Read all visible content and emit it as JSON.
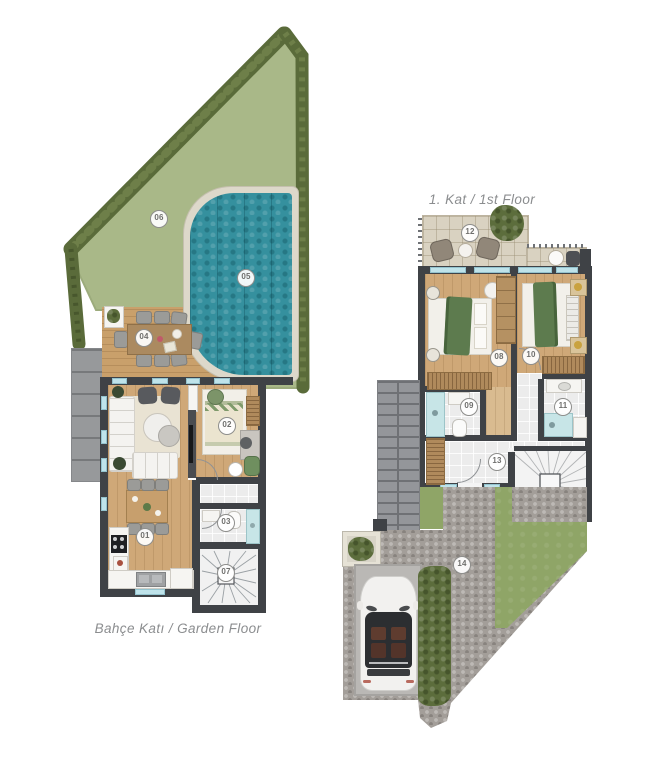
{
  "plans": {
    "garden": {
      "label": "Bahçe Katı / Garden Floor"
    },
    "first": {
      "label": "1. Kat / 1st Floor"
    }
  },
  "markers": {
    "m01": "01",
    "m02": "02",
    "m03": "03",
    "m04": "04",
    "m05": "05",
    "m06": "06",
    "m07": "07",
    "m08": "08",
    "m09": "09",
    "m10": "10",
    "m11": "11",
    "m12": "12",
    "m13": "13",
    "m14": "14"
  },
  "palette": {
    "wall": "#3f4246",
    "pool_water": "#35909e",
    "grass_garden": "#a9b888",
    "grass_yard": "#8fa567",
    "hedge": "#5c6d3c",
    "deck_wood": "#c9a06b",
    "interior_wood": "#cfa878",
    "terrace_tile": "#d9d2c1",
    "window": "#bfe3ea",
    "cobblestone": "#a39e99",
    "marker_text": "#6f6f6d",
    "label_text": "#8b8d8f",
    "accent_green": "#6b8f5e"
  }
}
